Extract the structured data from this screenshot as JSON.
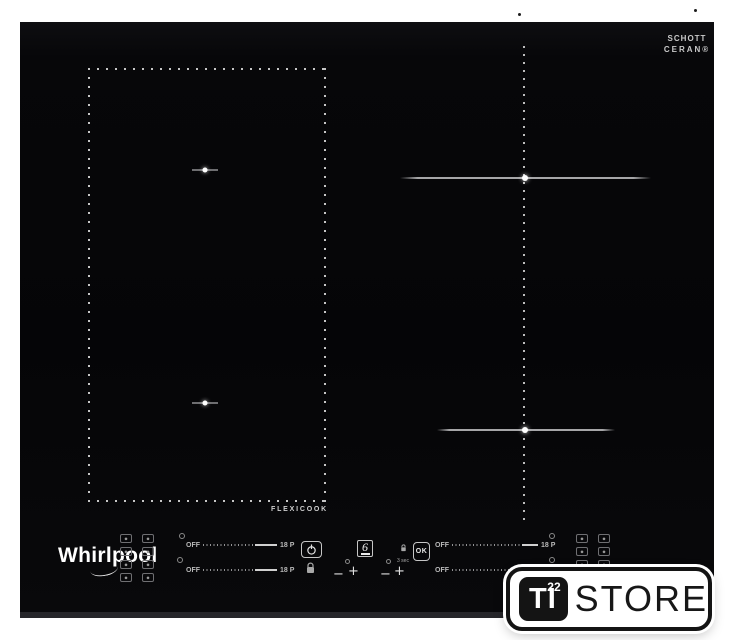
{
  "branding": {
    "schott_line1": "SCHOTT",
    "schott_line2": "CERAN®",
    "whirlpool": "Whirlpool",
    "flexicook": "FLEXICOOK"
  },
  "controls": {
    "slider_off": "OFF",
    "slider_max": "18 P",
    "minus": "−",
    "plus": "+",
    "six_sense": "6",
    "ok": "OK",
    "ok_hint": "3 sec"
  },
  "watermark": {
    "ti": "TI",
    "number": "22",
    "store": "STORE"
  },
  "colors": {
    "background": "#ffffff",
    "glass_surface": "#050507",
    "zone_markings": "#c6c6c6",
    "control_text": "#b9b9b9",
    "watermark_ink": "#141414"
  }
}
